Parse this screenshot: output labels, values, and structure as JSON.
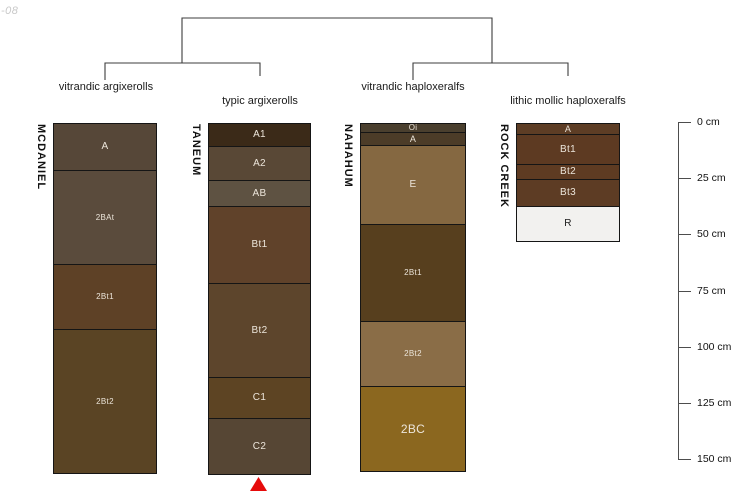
{
  "watermark": "-08",
  "figure": {
    "horizon_text_color": "#ece5da",
    "line_color": "#3c3c3c",
    "marker_color": "#e60b0b",
    "dendrogram": {
      "groups": [
        {
          "label": "vitrandic argixerolls",
          "cx": 106,
          "top": 81
        },
        {
          "label": "typic argixerolls",
          "cx": 260,
          "top": 95
        },
        {
          "label": "vitrandic haploxeralfs",
          "cx": 413,
          "top": 81
        },
        {
          "label": "lithic mollic haploxeralfs",
          "cx": 568,
          "top": 95
        }
      ]
    },
    "profiles": [
      {
        "series": "MCDANIEL",
        "taxon": "vitrandic argixerolls",
        "x": 53,
        "top": 123,
        "width": 102,
        "horizons": [
          {
            "name": "A",
            "h": 46,
            "color": "#564738",
            "fs": 10
          },
          {
            "name": "2BAt",
            "h": 94,
            "color": "#5a4b3c",
            "fs": 8
          },
          {
            "name": "2Bt1",
            "h": 65,
            "color": "#5e4126",
            "fs": 8
          },
          {
            "name": "2Bt2",
            "h": 144,
            "color": "#5a4424",
            "fs": 8
          }
        ]
      },
      {
        "series": "TANEUM",
        "taxon": "typic argixerolls",
        "x": 208,
        "top": 123,
        "width": 101,
        "marker": "red-triangle",
        "horizons": [
          {
            "name": "A1",
            "h": 22,
            "color": "#3b2a18",
            "fs": 10
          },
          {
            "name": "A2",
            "h": 34,
            "color": "#594836",
            "fs": 10
          },
          {
            "name": "AB",
            "h": 26,
            "color": "#5e5242",
            "fs": 10
          },
          {
            "name": "Bt1",
            "h": 77,
            "color": "#60422a",
            "fs": 10
          },
          {
            "name": "Bt2",
            "h": 94,
            "color": "#5d452c",
            "fs": 10
          },
          {
            "name": "C1",
            "h": 41,
            "color": "#5d4423",
            "fs": 10
          },
          {
            "name": "C2",
            "h": 56,
            "color": "#564634",
            "fs": 10
          }
        ]
      },
      {
        "series": "NAHAHUM",
        "taxon": "vitrandic haploxeralfs",
        "x": 360,
        "top": 123,
        "width": 104,
        "horizons": [
          {
            "name": "Oi",
            "h": 8,
            "color": "#4a3f2e",
            "fs": 8
          },
          {
            "name": "A",
            "h": 13,
            "color": "#4c3c28",
            "fs": 9
          },
          {
            "name": "E",
            "h": 79,
            "color": "#856841",
            "fs": 10
          },
          {
            "name": "2Bt1",
            "h": 97,
            "color": "#573f1e",
            "fs": 8
          },
          {
            "name": "2Bt2",
            "h": 65,
            "color": "#8a6d47",
            "fs": 8
          },
          {
            "name": "2BC",
            "h": 85,
            "color": "#8b671f",
            "fs": 12
          }
        ]
      },
      {
        "series": "ROCK CREEK",
        "taxon": "lithic mollic haploxeralfs",
        "x": 516,
        "top": 123,
        "width": 102,
        "horizons": [
          {
            "name": "A",
            "h": 10,
            "color": "#5d3d25",
            "fs": 9
          },
          {
            "name": "Bt1",
            "h": 30,
            "color": "#5d3a22",
            "fs": 10
          },
          {
            "name": "Bt2",
            "h": 15,
            "color": "#5e3b22",
            "fs": 10
          },
          {
            "name": "Bt3",
            "h": 27,
            "color": "#5d3c24",
            "fs": 10
          },
          {
            "name": "R",
            "h": 35,
            "color": "#f2f1ef",
            "fs": 10,
            "text": "#1a1a1a"
          }
        ]
      }
    ],
    "depth_axis": {
      "unit": "cm",
      "x": 678,
      "top": 122,
      "spacing": 56.17,
      "tick_len": 13,
      "ticks": [
        "0 cm",
        "25 cm",
        "50 cm",
        "75 cm",
        "100 cm",
        "125 cm",
        "150 cm"
      ]
    }
  },
  "chart_data": {
    "type": "table",
    "title": "Soil profile sketches grouped by taxonomic subgroup (dendrogram) with depth scale",
    "depth_axis": {
      "label": "cm",
      "ticks_cm": [
        0,
        25,
        50,
        75,
        100,
        125,
        150
      ]
    },
    "dendrogram_groups": [
      [
        "vitrandic argixerolls",
        "typic argixerolls"
      ],
      [
        "vitrandic haploxeralfs",
        "lithic mollic haploxeralfs"
      ]
    ],
    "profiles": [
      {
        "series": "MCDANIEL",
        "taxon": "vitrandic argixerolls",
        "horizons": [
          {
            "name": "A",
            "top_cm": 0,
            "bottom_cm": 21
          },
          {
            "name": "2BAt",
            "top_cm": 21,
            "bottom_cm": 63
          },
          {
            "name": "2Bt1",
            "top_cm": 63,
            "bottom_cm": 92
          },
          {
            "name": "2Bt2",
            "top_cm": 92,
            "bottom_cm": 156
          }
        ]
      },
      {
        "series": "TANEUM",
        "taxon": "typic argixerolls",
        "horizons": [
          {
            "name": "A1",
            "top_cm": 0,
            "bottom_cm": 10
          },
          {
            "name": "A2",
            "top_cm": 10,
            "bottom_cm": 25
          },
          {
            "name": "AB",
            "top_cm": 25,
            "bottom_cm": 37
          },
          {
            "name": "Bt1",
            "top_cm": 37,
            "bottom_cm": 71
          },
          {
            "name": "Bt2",
            "top_cm": 71,
            "bottom_cm": 113
          },
          {
            "name": "C1",
            "top_cm": 113,
            "bottom_cm": 131
          },
          {
            "name": "C2",
            "top_cm": 131,
            "bottom_cm": 156
          }
        ]
      },
      {
        "series": "NAHAHUM",
        "taxon": "vitrandic haploxeralfs",
        "horizons": [
          {
            "name": "Oi",
            "top_cm": 0,
            "bottom_cm": 4
          },
          {
            "name": "A",
            "top_cm": 4,
            "bottom_cm": 10
          },
          {
            "name": "E",
            "top_cm": 10,
            "bottom_cm": 45
          },
          {
            "name": "2Bt1",
            "top_cm": 45,
            "bottom_cm": 88
          },
          {
            "name": "2Bt2",
            "top_cm": 88,
            "bottom_cm": 117
          },
          {
            "name": "2BC",
            "top_cm": 117,
            "bottom_cm": 155
          }
        ]
      },
      {
        "series": "ROCK CREEK",
        "taxon": "lithic mollic haploxeralfs",
        "horizons": [
          {
            "name": "A",
            "top_cm": 0,
            "bottom_cm": 5
          },
          {
            "name": "Bt1",
            "top_cm": 5,
            "bottom_cm": 18
          },
          {
            "name": "Bt2",
            "top_cm": 18,
            "bottom_cm": 25
          },
          {
            "name": "Bt3",
            "top_cm": 25,
            "bottom_cm": 37
          },
          {
            "name": "R",
            "top_cm": 37,
            "bottom_cm": 52
          }
        ]
      }
    ]
  }
}
